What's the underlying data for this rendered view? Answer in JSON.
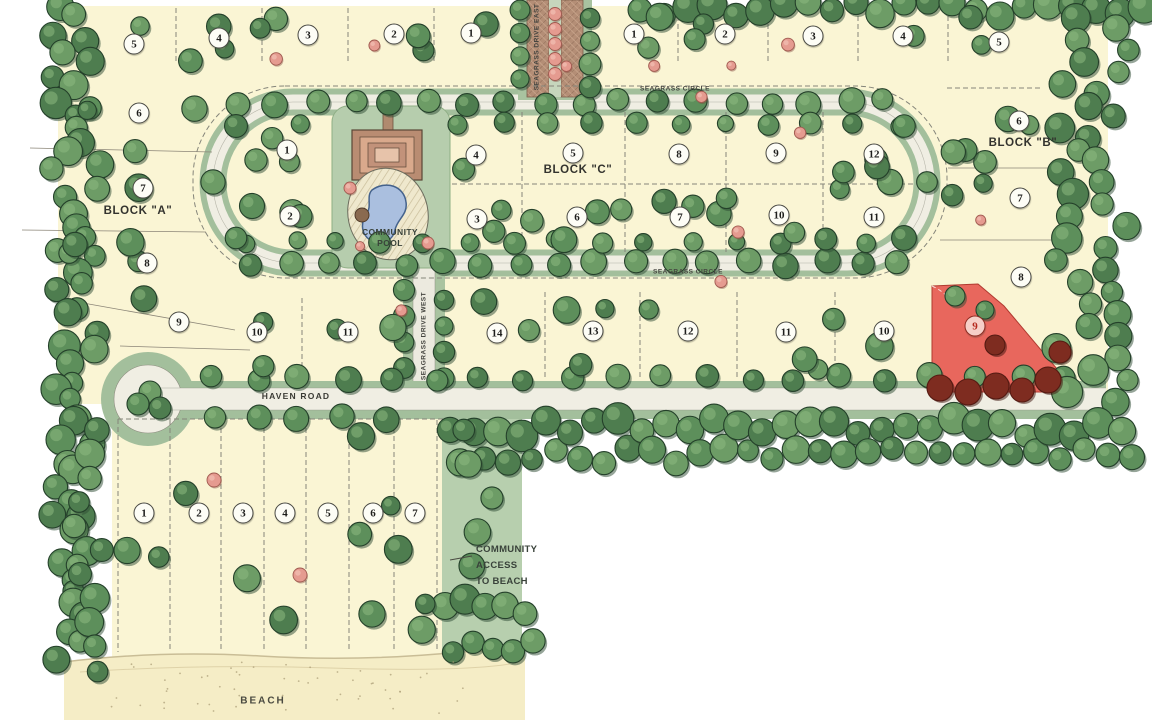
{
  "map": {
    "title": "Seagrass community site plan",
    "roads": {
      "seagrass_circle_top": "SEAGRASS CIRCLE",
      "seagrass_circle_bottom": "SEAGRASS CIRCLE",
      "seagrass_drive_east": "SEAGRASS DRIVE EAST",
      "seagrass_drive_west": "SEAGRASS DRIVE WEST",
      "haven_road": "HAVEN ROAD"
    },
    "blocks": [
      {
        "id": "block-a",
        "label": "BLOCK \"A\"",
        "x": 138,
        "y": 211
      },
      {
        "id": "block-b",
        "label": "BLOCK \"B\"",
        "x": 1023,
        "y": 143
      },
      {
        "id": "block-c",
        "label": "BLOCK \"C\"",
        "x": 578,
        "y": 170
      }
    ],
    "amenities": {
      "pool_label_lines": [
        "COMMUNITY",
        "POOL"
      ],
      "beach_access_lines": [
        "COMMUNITY",
        "ACCESS",
        "TO BEACH"
      ],
      "beach_label": "BEACH"
    },
    "highlight": {
      "lot": "9",
      "block": "B",
      "color": "#e8675d"
    },
    "lots": [
      {
        "n": "5",
        "x": 134,
        "y": 44,
        "g": "block-a"
      },
      {
        "n": "4",
        "x": 219,
        "y": 38,
        "g": "block-a"
      },
      {
        "n": "3",
        "x": 308,
        "y": 35,
        "g": "block-a"
      },
      {
        "n": "2",
        "x": 394,
        "y": 34,
        "g": "block-a"
      },
      {
        "n": "1",
        "x": 471,
        "y": 33,
        "g": "block-a"
      },
      {
        "n": "1",
        "x": 634,
        "y": 34,
        "g": "block-b"
      },
      {
        "n": "2",
        "x": 725,
        "y": 34,
        "g": "block-b"
      },
      {
        "n": "3",
        "x": 813,
        "y": 36,
        "g": "block-b"
      },
      {
        "n": "4",
        "x": 903,
        "y": 36,
        "g": "block-b"
      },
      {
        "n": "5",
        "x": 999,
        "y": 42,
        "g": "block-b"
      },
      {
        "n": "6",
        "x": 139,
        "y": 113,
        "g": "block-a"
      },
      {
        "n": "7",
        "x": 143,
        "y": 188,
        "g": "block-a"
      },
      {
        "n": "8",
        "x": 147,
        "y": 263,
        "g": "block-a"
      },
      {
        "n": "9",
        "x": 179,
        "y": 322,
        "g": "block-a"
      },
      {
        "n": "6",
        "x": 1019,
        "y": 121,
        "g": "block-b"
      },
      {
        "n": "7",
        "x": 1020,
        "y": 198,
        "g": "block-b"
      },
      {
        "n": "8",
        "x": 1021,
        "y": 277,
        "g": "block-b"
      },
      {
        "n": "9",
        "x": 975,
        "y": 326,
        "g": "block-b",
        "highlighted": true
      },
      {
        "n": "1",
        "x": 287,
        "y": 150,
        "g": "block-c"
      },
      {
        "n": "4",
        "x": 476,
        "y": 155,
        "g": "block-c"
      },
      {
        "n": "5",
        "x": 573,
        "y": 153,
        "g": "block-c"
      },
      {
        "n": "8",
        "x": 679,
        "y": 154,
        "g": "block-c"
      },
      {
        "n": "9",
        "x": 776,
        "y": 153,
        "g": "block-c"
      },
      {
        "n": "12",
        "x": 874,
        "y": 154,
        "g": "block-c"
      },
      {
        "n": "2",
        "x": 290,
        "y": 216,
        "g": "block-c"
      },
      {
        "n": "3",
        "x": 477,
        "y": 219,
        "g": "block-c"
      },
      {
        "n": "6",
        "x": 577,
        "y": 217,
        "g": "block-c"
      },
      {
        "n": "7",
        "x": 680,
        "y": 217,
        "g": "block-c"
      },
      {
        "n": "10",
        "x": 779,
        "y": 215,
        "g": "block-c"
      },
      {
        "n": "11",
        "x": 874,
        "y": 217,
        "g": "block-c"
      },
      {
        "n": "10",
        "x": 257,
        "y": 332,
        "g": "block-a"
      },
      {
        "n": "11",
        "x": 348,
        "y": 332,
        "g": "block-a"
      },
      {
        "n": "14",
        "x": 497,
        "y": 333,
        "g": "block-c"
      },
      {
        "n": "13",
        "x": 593,
        "y": 331,
        "g": "block-c"
      },
      {
        "n": "12",
        "x": 688,
        "y": 331,
        "g": "block-c"
      },
      {
        "n": "11",
        "x": 786,
        "y": 332,
        "g": "block-b"
      },
      {
        "n": "10",
        "x": 884,
        "y": 331,
        "g": "block-b"
      },
      {
        "n": "1",
        "x": 144,
        "y": 513,
        "g": "south"
      },
      {
        "n": "2",
        "x": 199,
        "y": 513,
        "g": "south"
      },
      {
        "n": "3",
        "x": 243,
        "y": 513,
        "g": "south"
      },
      {
        "n": "4",
        "x": 285,
        "y": 513,
        "g": "south"
      },
      {
        "n": "5",
        "x": 328,
        "y": 513,
        "g": "south"
      },
      {
        "n": "6",
        "x": 373,
        "y": 513,
        "g": "south"
      },
      {
        "n": "7",
        "x": 415,
        "y": 513,
        "g": "south"
      }
    ]
  }
}
